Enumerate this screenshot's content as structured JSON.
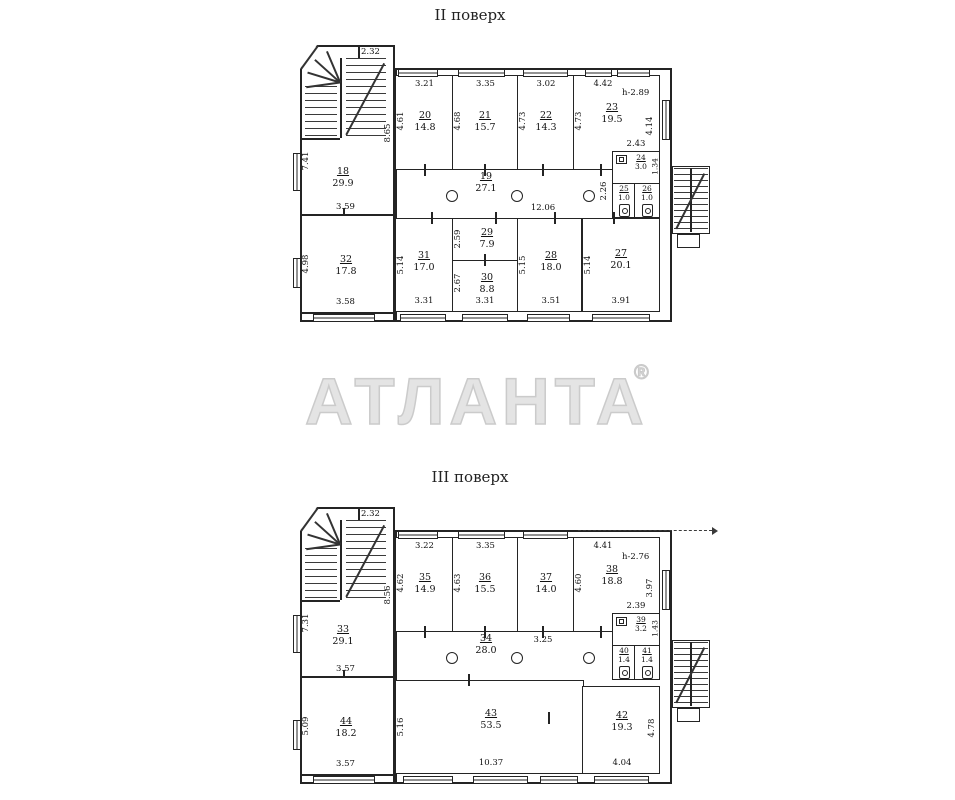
{
  "titles": {
    "floor2": "II поверх",
    "floor3": "III поверх"
  },
  "watermark": {
    "text": "АТЛАНТА",
    "reg": "®"
  },
  "f2": {
    "rooms": {
      "r18": {
        "n": "18",
        "a": "29.9"
      },
      "r19": {
        "n": "19",
        "a": "27.1"
      },
      "r20": {
        "n": "20",
        "a": "14.8"
      },
      "r21": {
        "n": "21",
        "a": "15.7"
      },
      "r22": {
        "n": "22",
        "a": "14.3"
      },
      "r23": {
        "n": "23",
        "a": "19.5"
      },
      "r24": {
        "n": "24",
        "a": "3.0"
      },
      "r25": {
        "n": "25",
        "a": "1.0"
      },
      "r26": {
        "n": "26",
        "a": "1.0"
      },
      "r27": {
        "n": "27",
        "a": "20.1"
      },
      "r28": {
        "n": "28",
        "a": "18.0"
      },
      "r29": {
        "n": "29",
        "a": "7.9"
      },
      "r30": {
        "n": "30",
        "a": "8.8"
      },
      "r31": {
        "n": "31",
        "a": "17.0"
      },
      "r32": {
        "n": "32",
        "a": "17.8"
      }
    },
    "dims": {
      "stair": "2.32",
      "r18l": "7.41",
      "r18r": "8.65",
      "r18b": "3.59",
      "r20t": "3.21",
      "r20l": "4.61",
      "r21t": "3.35",
      "r21l": "4.68",
      "r22t": "3.02",
      "r22l": "4.73",
      "r23t": "4.42",
      "r23l": "4.73",
      "r23r": "4.14",
      "h": "h-2.89",
      "r24t": "2.43",
      "r24r": "1.34",
      "corr": "12.06",
      "corrw": "2.26",
      "r32l": "4.98",
      "r32b": "3.58",
      "r31l": "5.14",
      "r31b": "3.31",
      "r29l": "2.59",
      "r30l": "2.67",
      "r30b": "3.31",
      "r28l": "5.15",
      "r28b": "3.51",
      "r27l": "5.14",
      "r27b": "3.91"
    }
  },
  "f3": {
    "rooms": {
      "r33": {
        "n": "33",
        "a": "29.1"
      },
      "r34": {
        "n": "34",
        "a": "28.0"
      },
      "r35": {
        "n": "35",
        "a": "14.9"
      },
      "r36": {
        "n": "36",
        "a": "15.5"
      },
      "r37": {
        "n": "37",
        "a": "14.0"
      },
      "r38": {
        "n": "38",
        "a": "18.8"
      },
      "r39": {
        "n": "39",
        "a": "3.2"
      },
      "r40": {
        "n": "40",
        "a": "1.4"
      },
      "r41": {
        "n": "41",
        "a": "1.4"
      },
      "r42": {
        "n": "42",
        "a": "19.3"
      },
      "r43": {
        "n": "43",
        "a": "53.5"
      },
      "r44": {
        "n": "44",
        "a": "18.2"
      }
    },
    "dims": {
      "stair": "2.32",
      "r33l": "7.31",
      "r33r": "8.56",
      "r33b": "3.57",
      "r35t": "3.22",
      "r35l": "4.62",
      "r36t": "3.35",
      "r36l": "4.63",
      "r37b": "3.25",
      "r38t": "4.41",
      "r38l": "4.60",
      "r38r": "3.97",
      "h": "h-2.76",
      "r39t": "2.39",
      "r39r": "1.43",
      "r44l": "5.09",
      "r44b": "3.57",
      "r43l": "5.16",
      "r43b": "10.37",
      "r42r": "4.78",
      "r42b": "4.04"
    }
  }
}
